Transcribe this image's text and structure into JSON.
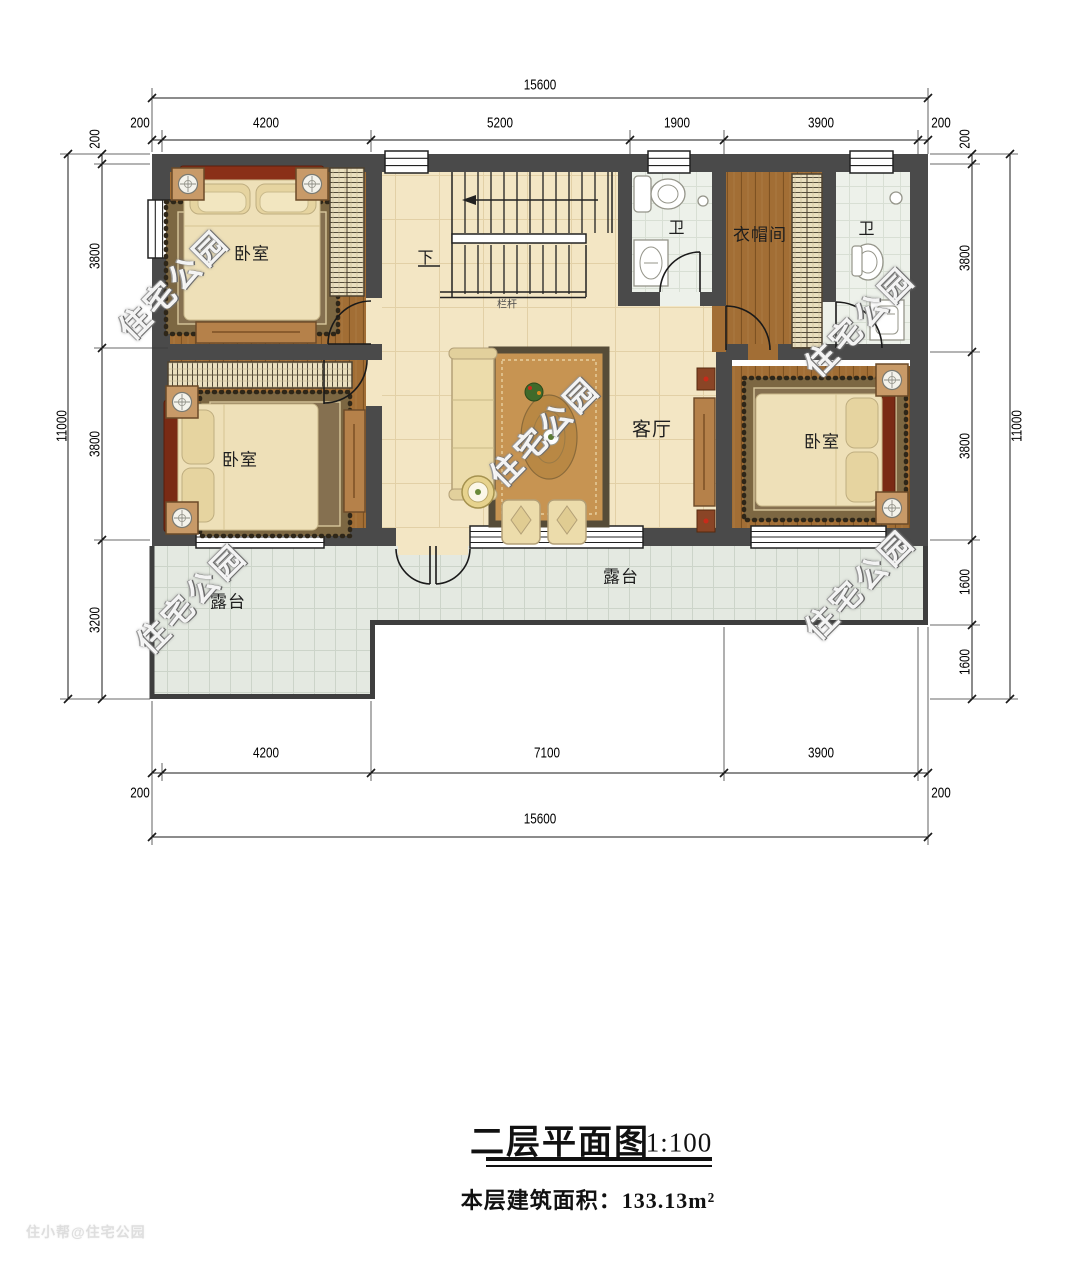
{
  "title_block": {
    "title": "二层平面图",
    "scale": "1:100",
    "area_text": "本层建筑面积：133.13m²"
  },
  "watermarks": {
    "diagonal": "住宅公园",
    "corner": "住小帮@住宅公园"
  },
  "rooms": {
    "bedroom_top_left": "卧室",
    "bedroom_bottom_left": "卧室",
    "bedroom_right": "卧室",
    "living_room": "客厅",
    "bath_left": "卫",
    "bath_right": "卫",
    "cloakroom": "衣帽间",
    "terrace_left": "露台",
    "terrace_right": "露台",
    "stairs_down": "下",
    "railing": "栏杆"
  },
  "dimensions": {
    "top": {
      "total": "15600",
      "segments": [
        "200",
        "4200",
        "5200",
        "1900",
        "3900",
        "200"
      ]
    },
    "bottom": {
      "total": "15600",
      "left_wall": "200",
      "right_wall": "200",
      "segments": [
        "4200",
        "7100",
        "3900"
      ]
    },
    "left": {
      "total": "11000",
      "segments": [
        "200",
        "3800",
        "3800",
        "3200"
      ]
    },
    "right": {
      "total": "11000",
      "segments": [
        "200",
        "3800",
        "3800",
        "1600",
        "1600"
      ]
    }
  }
}
